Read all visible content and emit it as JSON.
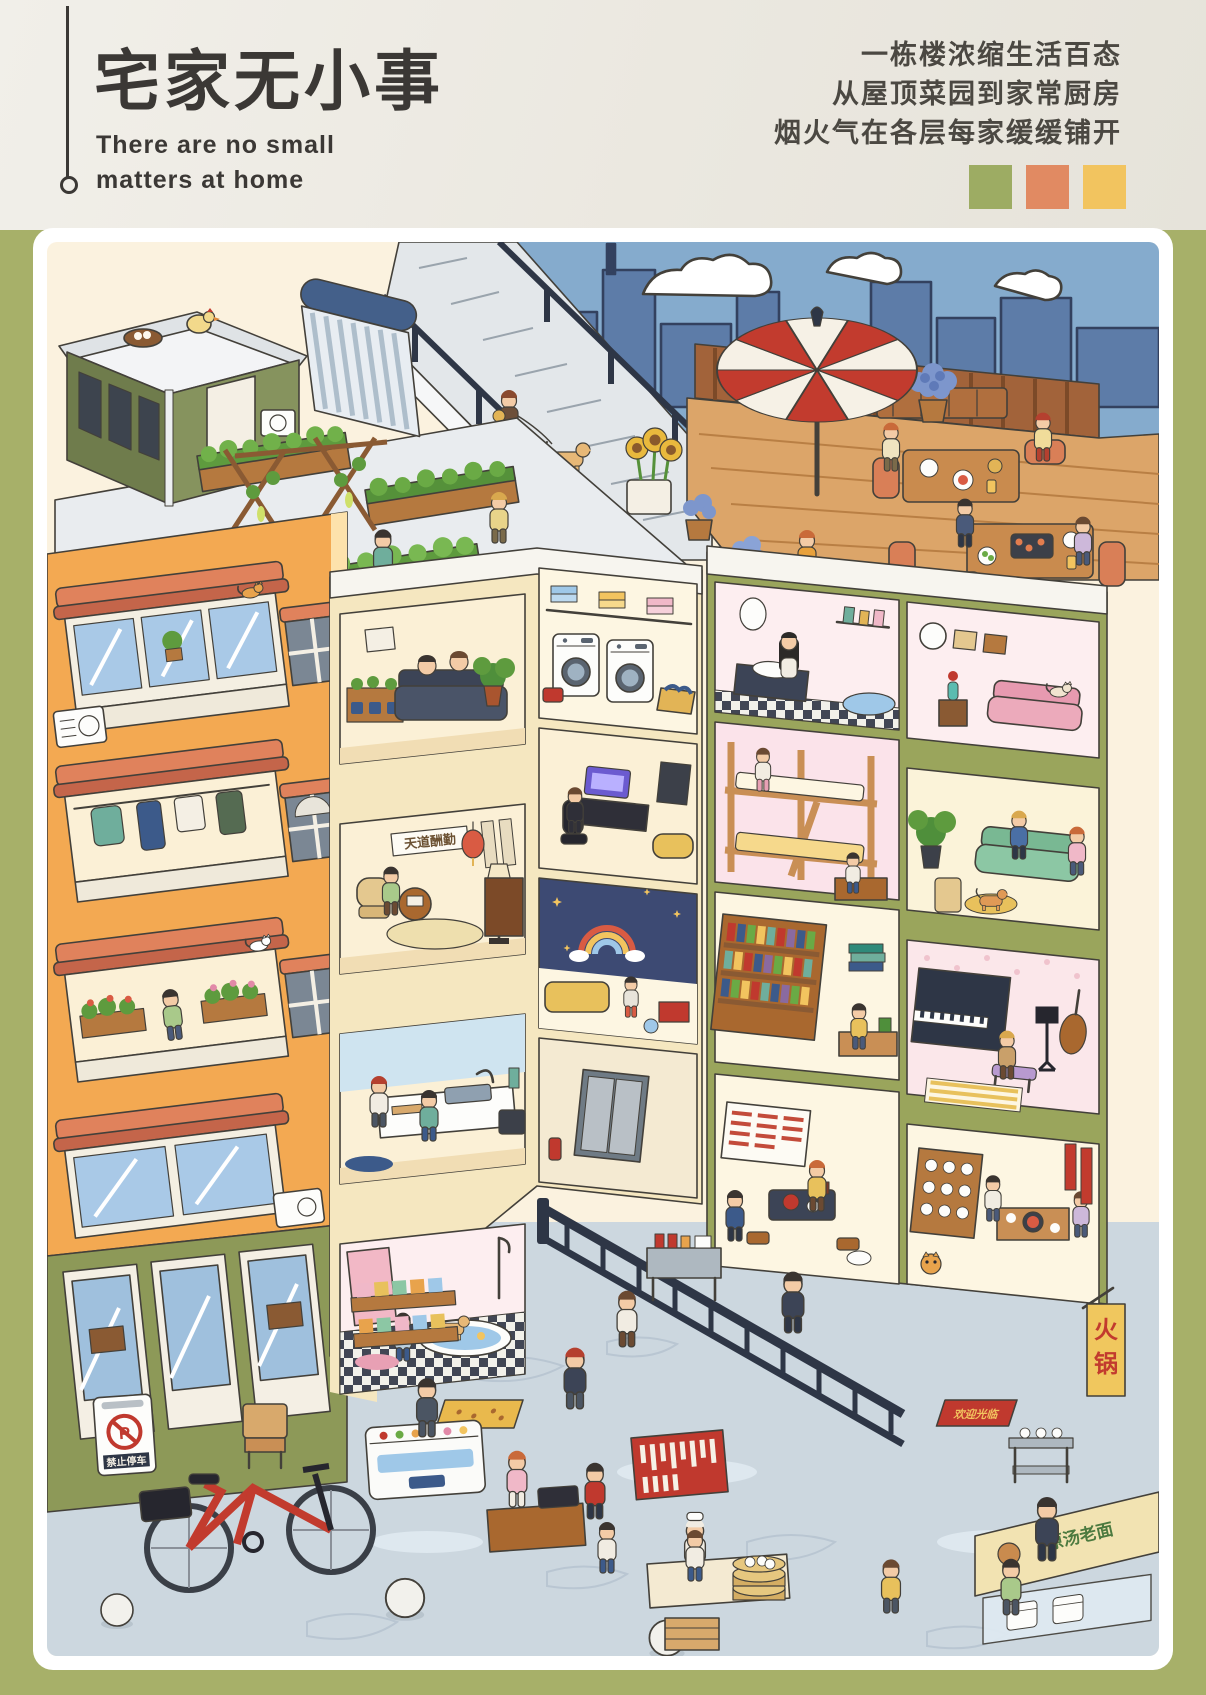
{
  "header": {
    "title": "宅家无小事",
    "subtitle": [
      "There are no small",
      "matters at home"
    ],
    "tagline": [
      "一栋楼浓缩生活百态",
      "从屋顶菜园到家常厨房",
      "烟火气在各层每家缓缓铺开"
    ],
    "swatches": [
      "#9dac63",
      "#e18a62",
      "#f2c45f"
    ]
  },
  "scene": {
    "signs": {
      "no_parking_symbol": "P",
      "no_parking": "禁止停车",
      "tea_plaque": "天道酬勤",
      "hotpot_char_top": "火",
      "hotpot_char_bottom": "锅",
      "noodle_stall": "原汤老面",
      "welcome_mat": "欢迎光临"
    },
    "palette": {
      "page_green": "#a7b069",
      "paper_cream": "#fbf2df",
      "facade_orange": "#f3a952",
      "awning_salmon": "#e0825c",
      "roof_olive": "#8d9958",
      "parasol_red": "#c23b2e",
      "water_blue": "#85abcd",
      "street_gray": "#ccd7df",
      "wood": "#c98f55",
      "accent_navy": "#3a4458"
    }
  }
}
